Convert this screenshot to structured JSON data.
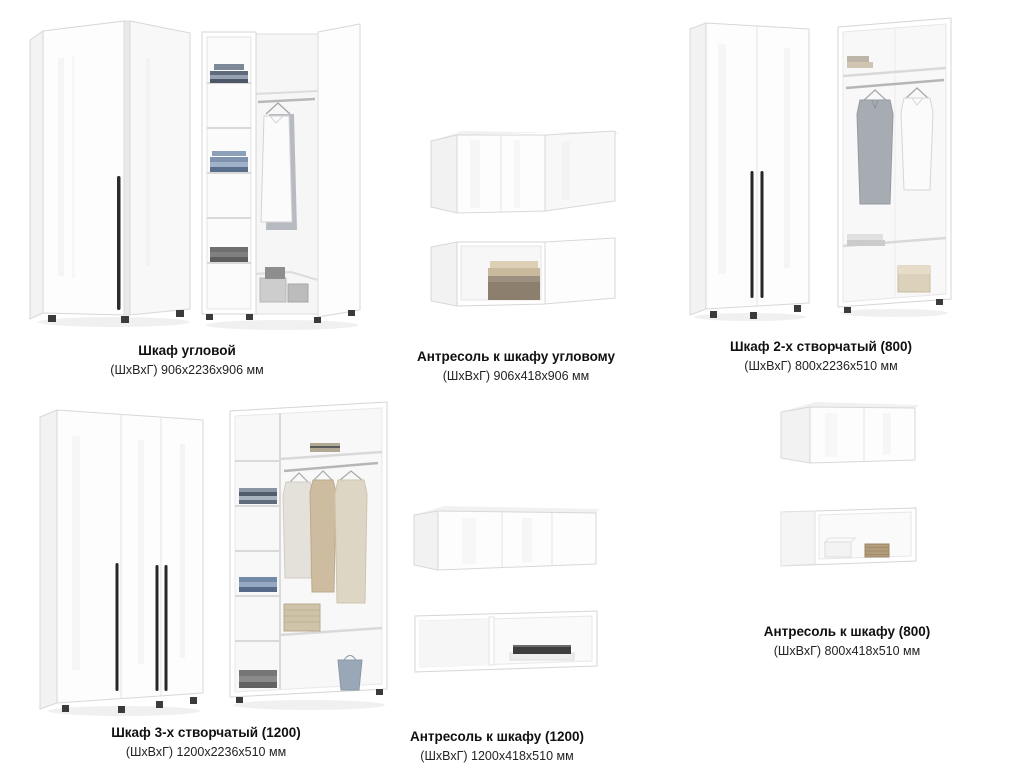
{
  "page": {
    "background": "#ffffff",
    "text_color": "#101010"
  },
  "colors": {
    "furniture_white": "#fdfdfd",
    "outline_gray": "#d6d6d6",
    "interior_gray": "#f7f7f7",
    "handle_black": "#272727",
    "basket_tan": "#cfc3aa",
    "clothes_blue": "#7289a8",
    "clothes_gray": "#a7abb2"
  },
  "products": [
    {
      "name": "Шкаф угловой",
      "dimensions": "(ШхВхГ) 906х2236х906 мм"
    },
    {
      "name": "Антресоль к шкафу угловому",
      "dimensions": "(ШхВхГ) 906х418х906 мм"
    },
    {
      "name": "Шкаф 2-х створчатый (800)",
      "dimensions": "(ШхВхГ) 800х2236х510 мм"
    },
    {
      "name": "Шкаф 3-х створчатый (1200)",
      "dimensions": "(ШхВхГ) 1200х2236х510 мм"
    },
    {
      "name": "Антресоль к шкафу (1200)",
      "dimensions": "(ШхВхГ) 1200х418х510 мм"
    },
    {
      "name": "Антресоль к шкафу (800)",
      "dimensions": "(ШхВхГ) 800х418х510 мм"
    }
  ]
}
